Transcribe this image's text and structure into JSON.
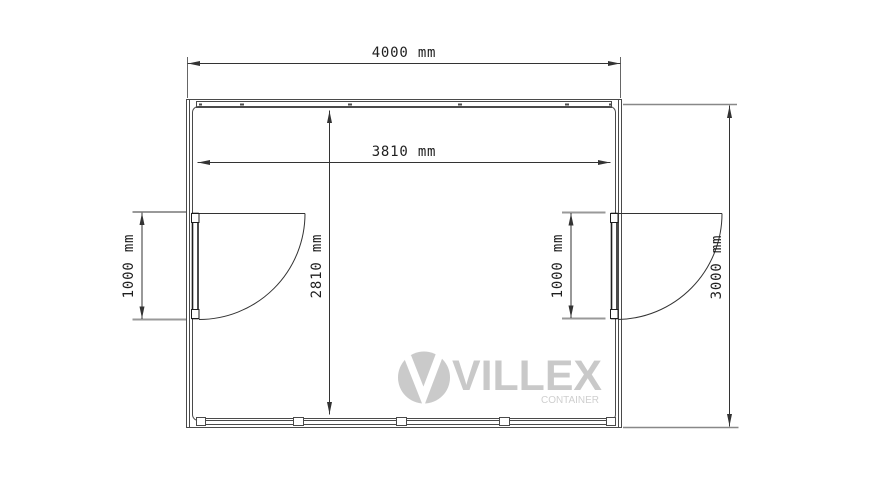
{
  "diagram": {
    "type": "container-floor-plan",
    "unit": "mm",
    "dimensions": {
      "outer_width": "4000 mm",
      "inner_width": "3810 mm",
      "inner_depth": "2810 mm",
      "outer_depth": "3000 mm",
      "door_left_width": "1000 mm",
      "door_right_width": "1000 mm"
    },
    "doors": [
      {
        "name": "left-swing-door"
      },
      {
        "name": "right-swing-door"
      }
    ]
  },
  "logo": {
    "brand": "VILLEX",
    "tagline": "CONTAINER"
  },
  "colors": {
    "background": "#ffffff",
    "wall_line": "#4a4a4a",
    "dimension_line": "#333333",
    "extension_line_gray": "#999999",
    "text": "#1f1f1f",
    "logo_gray": "#c9c9c9"
  }
}
